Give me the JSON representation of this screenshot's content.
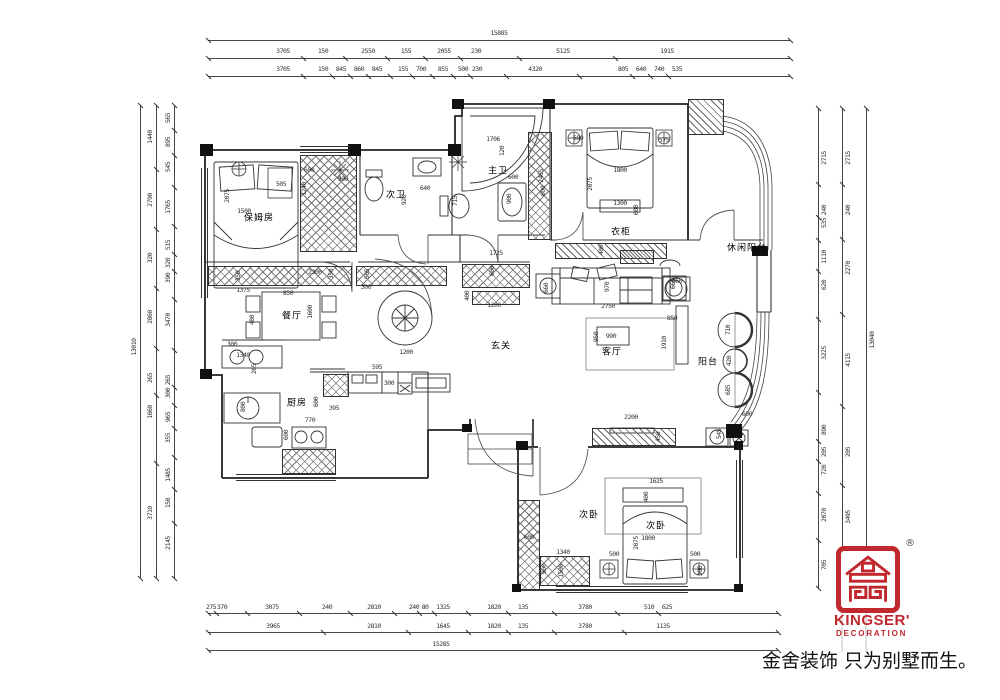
{
  "page": {
    "background": "#ffffff",
    "line_color": "#2b2b2b",
    "accent_red": "#c0282e"
  },
  "logo": {
    "brand": "KINGSER'",
    "sub": "DECORATION",
    "reg": "®",
    "tagline": "金舍装饰 只为别墅而生。"
  },
  "plan": {
    "rooms": [
      {
        "t": "保姆房",
        "x": 259,
        "y": 219
      },
      {
        "t": "次卫",
        "x": 396,
        "y": 196
      },
      {
        "t": "主卫",
        "x": 498,
        "y": 172
      },
      {
        "t": "餐厅",
        "x": 292,
        "y": 317
      },
      {
        "t": "厨房",
        "x": 297,
        "y": 404
      },
      {
        "t": "玄关",
        "x": 501,
        "y": 347
      },
      {
        "t": "客厅",
        "x": 612,
        "y": 353
      },
      {
        "t": "休闲阳台",
        "x": 747,
        "y": 249
      },
      {
        "t": "阳台",
        "x": 708,
        "y": 363
      },
      {
        "t": "次卧",
        "x": 589,
        "y": 516
      },
      {
        "t": "次卧",
        "x": 656,
        "y": 527
      },
      {
        "t": "衣柜",
        "x": 621,
        "y": 233
      }
    ],
    "dims": [
      {
        "t": "2075",
        "x": 227,
        "y": 196,
        "r": 1
      },
      {
        "t": "1500",
        "x": 244,
        "y": 211
      },
      {
        "t": "505",
        "x": 281,
        "y": 184
      },
      {
        "t": "600",
        "x": 309,
        "y": 170
      },
      {
        "t": "900",
        "x": 343,
        "y": 179
      },
      {
        "t": "1240",
        "x": 304,
        "y": 189,
        "r": 1
      },
      {
        "t": "920",
        "x": 404,
        "y": 200,
        "r": 1
      },
      {
        "t": "640",
        "x": 425,
        "y": 188
      },
      {
        "t": "715",
        "x": 455,
        "y": 201,
        "r": 1
      },
      {
        "t": "1706",
        "x": 493,
        "y": 139
      },
      {
        "t": "120",
        "x": 502,
        "y": 151,
        "r": 1
      },
      {
        "t": "600",
        "x": 513,
        "y": 177
      },
      {
        "t": "900",
        "x": 509,
        "y": 199,
        "r": 1
      },
      {
        "t": "2465",
        "x": 541,
        "y": 176,
        "r": 1
      },
      {
        "t": "600",
        "x": 543,
        "y": 191,
        "r": 1
      },
      {
        "t": "680",
        "x": 578,
        "y": 138
      },
      {
        "t": "575",
        "x": 664,
        "y": 140
      },
      {
        "t": "2075",
        "x": 590,
        "y": 184,
        "r": 1
      },
      {
        "t": "1800",
        "x": 620,
        "y": 170
      },
      {
        "t": "1300",
        "x": 620,
        "y": 203
      },
      {
        "t": "600",
        "x": 636,
        "y": 210,
        "r": 1
      },
      {
        "t": "400",
        "x": 601,
        "y": 250,
        "r": 1
      },
      {
        "t": "1725",
        "x": 496,
        "y": 253
      },
      {
        "t": "350",
        "x": 238,
        "y": 276,
        "r": 1
      },
      {
        "t": "1375",
        "x": 243,
        "y": 290
      },
      {
        "t": "2300",
        "x": 315,
        "y": 272
      },
      {
        "t": "350",
        "x": 331,
        "y": 274,
        "r": 1
      },
      {
        "t": "565",
        "x": 367,
        "y": 274,
        "r": 1
      },
      {
        "t": "300",
        "x": 366,
        "y": 287
      },
      {
        "t": "850",
        "x": 288,
        "y": 293
      },
      {
        "t": "480",
        "x": 252,
        "y": 320,
        "r": 1
      },
      {
        "t": "1600",
        "x": 310,
        "y": 312,
        "r": 1
      },
      {
        "t": "300",
        "x": 232,
        "y": 344
      },
      {
        "t": "1340",
        "x": 243,
        "y": 355
      },
      {
        "t": "265",
        "x": 254,
        "y": 369,
        "r": 1
      },
      {
        "t": "1200",
        "x": 406,
        "y": 352
      },
      {
        "t": "600",
        "x": 492,
        "y": 271,
        "r": 1
      },
      {
        "t": "400",
        "x": 467,
        "y": 296,
        "r": 1
      },
      {
        "t": "1200",
        "x": 494,
        "y": 305
      },
      {
        "t": "970",
        "x": 607,
        "y": 287,
        "r": 1
      },
      {
        "t": "2750",
        "x": 608,
        "y": 306
      },
      {
        "t": "660",
        "x": 546,
        "y": 288,
        "r": 1
      },
      {
        "t": "660",
        "x": 673,
        "y": 284,
        "r": 1
      },
      {
        "t": "990",
        "x": 611,
        "y": 336
      },
      {
        "t": "950",
        "x": 596,
        "y": 337,
        "r": 1
      },
      {
        "t": "850",
        "x": 672,
        "y": 318
      },
      {
        "t": "1910",
        "x": 664,
        "y": 343,
        "r": 1
      },
      {
        "t": "2200",
        "x": 631,
        "y": 417
      },
      {
        "t": "450",
        "x": 658,
        "y": 437,
        "r": 1
      },
      {
        "t": "1625",
        "x": 656,
        "y": 481
      },
      {
        "t": "400",
        "x": 646,
        "y": 497,
        "r": 1
      },
      {
        "t": "1800",
        "x": 648,
        "y": 538
      },
      {
        "t": "2075",
        "x": 636,
        "y": 543,
        "r": 1
      },
      {
        "t": "500",
        "x": 614,
        "y": 554
      },
      {
        "t": "500",
        "x": 695,
        "y": 554
      },
      {
        "t": "300",
        "x": 700,
        "y": 571,
        "r": 1
      },
      {
        "t": "600",
        "x": 529,
        "y": 537
      },
      {
        "t": "1340",
        "x": 563,
        "y": 552
      },
      {
        "t": "900",
        "x": 544,
        "y": 569,
        "r": 1
      },
      {
        "t": "1500",
        "x": 561,
        "y": 571,
        "r": 1
      },
      {
        "t": "600",
        "x": 747,
        "y": 414
      },
      {
        "t": "545",
        "x": 719,
        "y": 434,
        "r": 1
      },
      {
        "t": "710",
        "x": 728,
        "y": 330,
        "r": 1
      },
      {
        "t": "420",
        "x": 729,
        "y": 361,
        "r": 1
      },
      {
        "t": "685",
        "x": 728,
        "y": 390,
        "r": 1
      },
      {
        "t": "660",
        "x": 677,
        "y": 281
      },
      {
        "t": "595",
        "x": 377,
        "y": 367
      },
      {
        "t": "600",
        "x": 316,
        "y": 402,
        "r": 1
      },
      {
        "t": "395",
        "x": 334,
        "y": 408
      },
      {
        "t": "300",
        "x": 389,
        "y": 383
      },
      {
        "t": "770",
        "x": 310,
        "y": 420
      },
      {
        "t": "600",
        "x": 286,
        "y": 435,
        "r": 1
      },
      {
        "t": "800",
        "x": 243,
        "y": 407,
        "r": 1
      }
    ],
    "chains": [
      {
        "o": "h",
        "line": 40,
        "a": 208,
        "b": 790,
        "lp": 33,
        "labels": [
          {
            "t": "15885",
            "c": 499
          }
        ]
      },
      {
        "o": "h",
        "line": 58,
        "a": 208,
        "b": 790,
        "lp": 51,
        "labels": [
          {
            "t": "3705",
            "c": 283
          },
          {
            "t": "150",
            "c": 323
          },
          {
            "t": "2550",
            "c": 368
          },
          {
            "t": "155",
            "c": 406
          },
          {
            "t": "2055",
            "c": 444
          },
          {
            "t": "230",
            "c": 476
          },
          {
            "t": "5125",
            "c": 563
          },
          {
            "t": "1915",
            "c": 667
          }
        ]
      },
      {
        "o": "h",
        "line": 76,
        "a": 208,
        "b": 790,
        "lp": 69,
        "labels": [
          {
            "t": "3705",
            "c": 283
          },
          {
            "t": "150",
            "c": 323
          },
          {
            "t": "845",
            "c": 341
          },
          {
            "t": "860",
            "c": 359
          },
          {
            "t": "845",
            "c": 377
          },
          {
            "t": "155",
            "c": 403
          },
          {
            "t": "700",
            "c": 421
          },
          {
            "t": "855",
            "c": 443
          },
          {
            "t": "500",
            "c": 463
          },
          {
            "t": "230",
            "c": 477
          },
          {
            "t": "4320",
            "c": 535
          },
          {
            "t": "805",
            "c": 623
          },
          {
            "t": "640",
            "c": 641
          },
          {
            "t": "740",
            "c": 659
          },
          {
            "t": "535",
            "c": 677
          }
        ]
      },
      {
        "o": "h",
        "line": 613,
        "a": 208,
        "b": 778,
        "lp": 607,
        "labels": [
          {
            "t": "275",
            "c": 211
          },
          {
            "t": "370",
            "c": 222
          },
          {
            "t": "3075",
            "c": 272
          },
          {
            "t": "240",
            "c": 327
          },
          {
            "t": "2810",
            "c": 374
          },
          {
            "t": "240",
            "c": 414
          },
          {
            "t": "80",
            "c": 425
          },
          {
            "t": "1325",
            "c": 443
          },
          {
            "t": "1820",
            "c": 494
          },
          {
            "t": "135",
            "c": 523
          },
          {
            "t": "3780",
            "c": 585
          },
          {
            "t": "510",
            "c": 649
          },
          {
            "t": "625",
            "c": 667
          }
        ]
      },
      {
        "o": "h",
        "line": 632,
        "a": 208,
        "b": 778,
        "lp": 626,
        "labels": [
          {
            "t": "3965",
            "c": 273
          },
          {
            "t": "2810",
            "c": 374
          },
          {
            "t": "1645",
            "c": 443
          },
          {
            "t": "1820",
            "c": 494
          },
          {
            "t": "135",
            "c": 523
          },
          {
            "t": "3780",
            "c": 585
          },
          {
            "t": "1135",
            "c": 663
          }
        ]
      },
      {
        "o": "h",
        "line": 650,
        "a": 208,
        "b": 778,
        "lp": 644,
        "labels": [
          {
            "t": "15285",
            "c": 441
          }
        ]
      },
      {
        "o": "v",
        "line": 140,
        "a": 105,
        "b": 578,
        "lp": 134,
        "labels": [
          {
            "t": "13010",
            "c": 347
          }
        ]
      },
      {
        "o": "v",
        "line": 156,
        "a": 105,
        "b": 578,
        "lp": 150,
        "labels": [
          {
            "t": "1440",
            "c": 137
          },
          {
            "t": "2790",
            "c": 200
          },
          {
            "t": "320",
            "c": 258
          },
          {
            "t": "2860",
            "c": 317
          },
          {
            "t": "265",
            "c": 378
          },
          {
            "t": "1660",
            "c": 412
          },
          {
            "t": "3710",
            "c": 513
          }
        ]
      },
      {
        "o": "v",
        "line": 174,
        "a": 105,
        "b": 578,
        "lp": 168,
        "labels": [
          {
            "t": "565",
            "c": 118
          },
          {
            "t": "895",
            "c": 142
          },
          {
            "t": "545",
            "c": 167
          },
          {
            "t": "1765",
            "c": 207
          },
          {
            "t": "515",
            "c": 245
          },
          {
            "t": "320",
            "c": 263
          },
          {
            "t": "390",
            "c": 278
          },
          {
            "t": "3470",
            "c": 320
          },
          {
            "t": "265",
            "c": 380
          },
          {
            "t": "300",
            "c": 393
          },
          {
            "t": "965",
            "c": 417
          },
          {
            "t": "355",
            "c": 438
          },
          {
            "t": "1485",
            "c": 475
          },
          {
            "t": "150",
            "c": 503
          },
          {
            "t": "2145",
            "c": 543
          }
        ]
      },
      {
        "o": "v",
        "line": 818,
        "a": 108,
        "b": 588,
        "lp": 824,
        "labels": [
          {
            "t": "2715",
            "c": 158
          },
          {
            "t": "240",
            "c": 210
          },
          {
            "t": "535",
            "c": 223
          },
          {
            "t": "1110",
            "c": 257
          },
          {
            "t": "620",
            "c": 285
          },
          {
            "t": "3225",
            "c": 353
          },
          {
            "t": "890",
            "c": 430
          },
          {
            "t": "205",
            "c": 452
          },
          {
            "t": "720",
            "c": 470
          },
          {
            "t": "2070",
            "c": 515
          },
          {
            "t": "705",
            "c": 565
          }
        ]
      },
      {
        "o": "v",
        "line": 842,
        "a": 108,
        "b": 588,
        "lp": 848,
        "labels": [
          {
            "t": "2715",
            "c": 158
          },
          {
            "t": "240",
            "c": 210
          },
          {
            "t": "2270",
            "c": 268
          },
          {
            "t": "4115",
            "c": 360
          },
          {
            "t": "205",
            "c": 452
          },
          {
            "t": "3495",
            "c": 517
          }
        ]
      },
      {
        "o": "v",
        "line": 866,
        "a": 108,
        "b": 588,
        "lp": 872,
        "labels": [
          {
            "t": "13040",
            "c": 340
          }
        ]
      }
    ]
  }
}
